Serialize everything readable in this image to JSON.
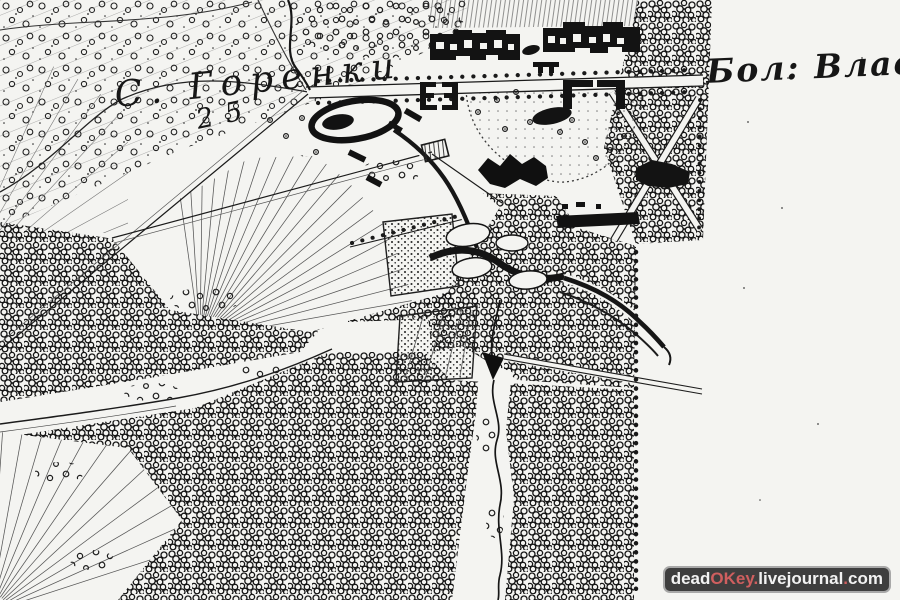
{
  "map": {
    "village_label": "С. Горенки",
    "distance_number": "25",
    "road_label": "Бол: Владим",
    "paper_color": "#f4f4f1",
    "ink_color": "#1a1a1a",
    "features": {
      "village": "selo-gorenki",
      "highway": "bolshaya-vladimirskaya-road",
      "estate": "gorenki-estate-buildings",
      "park": "landscape-park-with-ponds",
      "forest": "dense-forest",
      "river": "gorenka-river"
    }
  },
  "watermark": {
    "background": "#3e3e3e",
    "border_color": "#a8a8a8",
    "red": "#cf5f5f",
    "white": "#f2f2f2",
    "segments": [
      {
        "text": "dead",
        "tone": "white"
      },
      {
        "text": "OKey",
        "tone": "red"
      },
      {
        "text": ".",
        "tone": "red"
      },
      {
        "text": "livejournal",
        "tone": "white"
      },
      {
        "text": ".",
        "tone": "red"
      },
      {
        "text": "com",
        "tone": "white"
      }
    ]
  }
}
